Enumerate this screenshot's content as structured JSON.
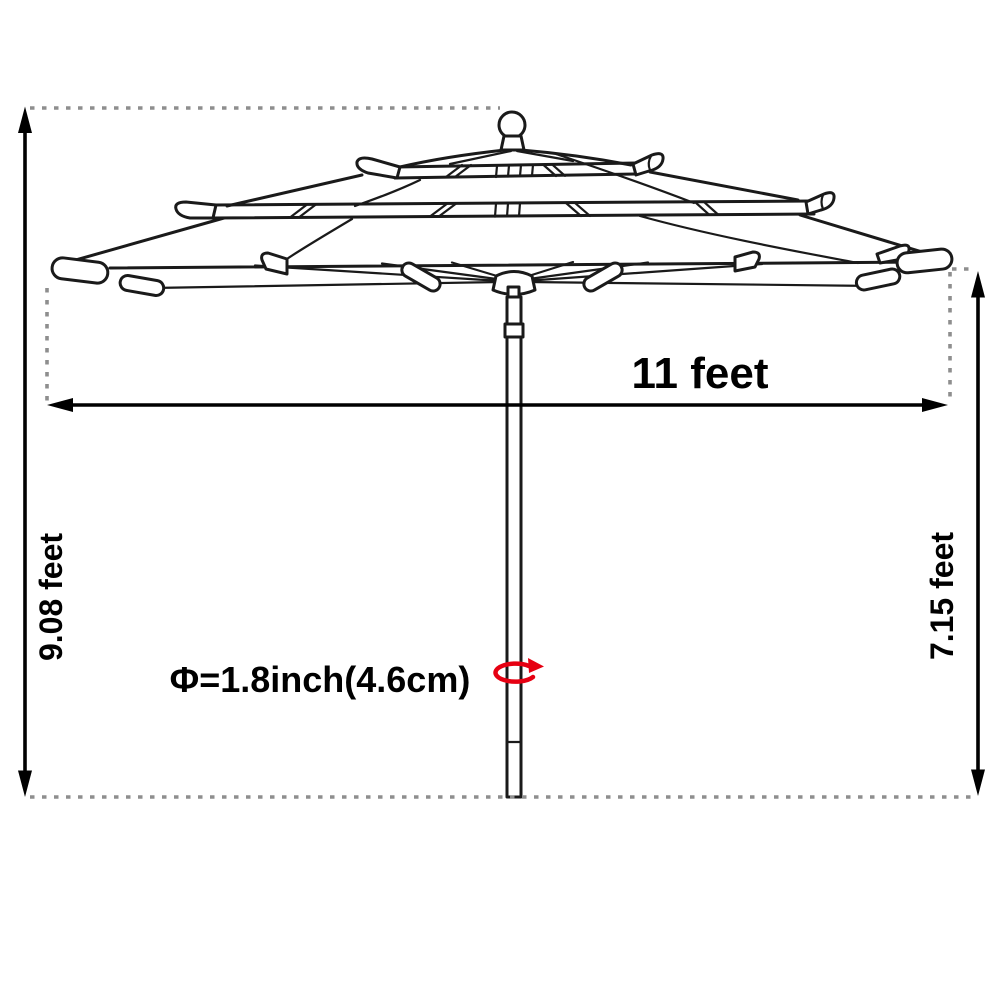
{
  "figure": {
    "type": "product-dimension-diagram",
    "subject": "3-tier patio market umbrella line drawing",
    "dimensions": {
      "canopy_width": "11 feet",
      "overall_height": "9.08 feet",
      "pole_height": "7.15 feet",
      "pole_diameter": "Φ=1.8inch(4.6cm)"
    },
    "colors": {
      "line": "#1a1a1a",
      "dimension": "#000000",
      "dashed_guide": "#8e8e8e",
      "rotation_arrow": "#e60012"
    },
    "icons": {
      "rotation": "rotation-arrow-icon"
    }
  }
}
